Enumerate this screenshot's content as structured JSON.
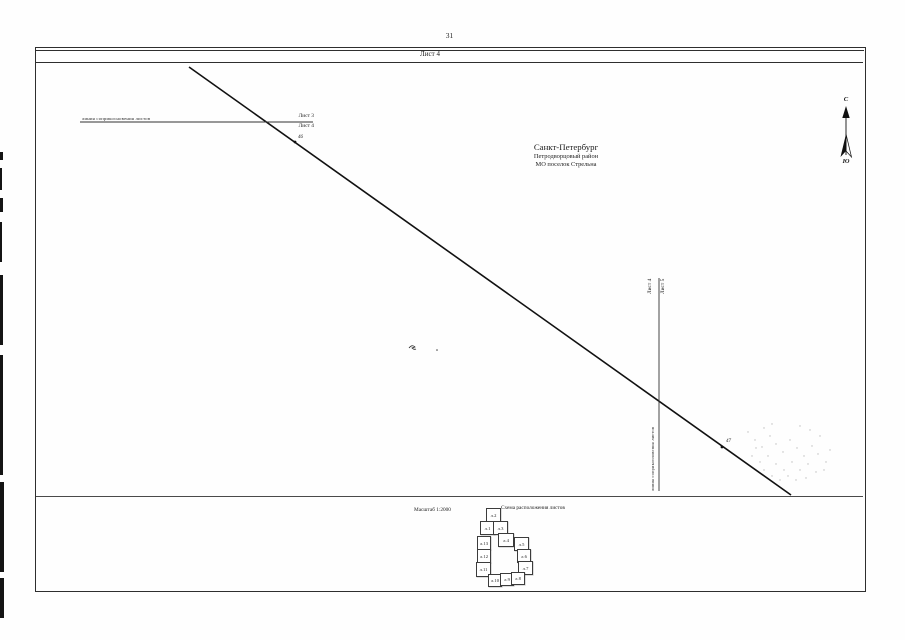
{
  "page": {
    "number": "31"
  },
  "sheet": {
    "title": "Лист 4"
  },
  "map": {
    "location": {
      "city": "Санкт-Петербург",
      "district": "Петродворцовый район",
      "municipality": "МО поселок Стрельна"
    },
    "compass": {
      "north_label": "С",
      "south_label": "Ю"
    },
    "join_line_top": {
      "caption": "линия соприкосновения листов",
      "sheet_above": "Лист 3",
      "sheet_below": "Лист 4"
    },
    "join_line_right": {
      "caption": "линия соприкосновения листов",
      "sheet_left": "Лист 4",
      "sheet_right": "Лист 5"
    },
    "boundary_points": [
      {
        "id": "46"
      },
      {
        "id": "47"
      }
    ]
  },
  "footer": {
    "scale_label": "Масштаб 1:2000",
    "scheme_title": "Схема расположения листов",
    "sheets": [
      {
        "label": "л.2"
      },
      {
        "label": "л.1"
      },
      {
        "label": "л.3"
      },
      {
        "label": "л.13"
      },
      {
        "label": "л.4"
      },
      {
        "label": "л.5"
      },
      {
        "label": "л.12"
      },
      {
        "label": "л.6"
      },
      {
        "label": "л.11"
      },
      {
        "label": "л.7"
      },
      {
        "label": "л.10"
      },
      {
        "label": "л.9"
      },
      {
        "label": "л.8"
      }
    ]
  }
}
